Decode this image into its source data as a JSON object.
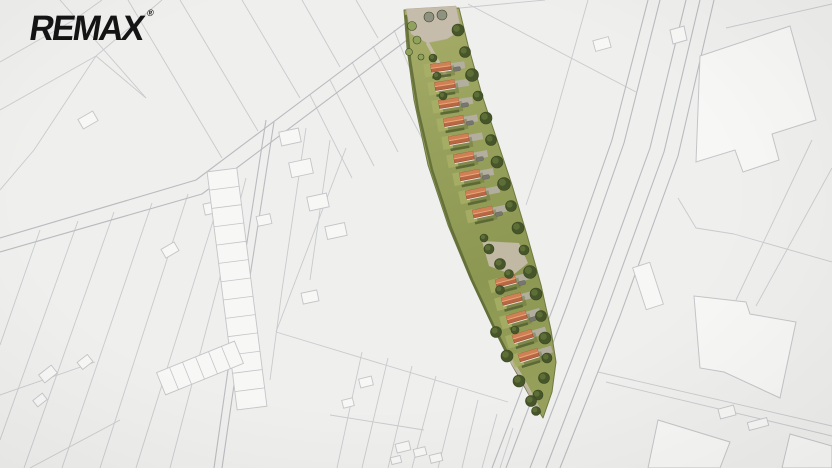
{
  "logo": {
    "text": "REMAX",
    "trademark": "®",
    "color": "#141414"
  },
  "canvas": {
    "width": 832,
    "height": 468,
    "background": "#efefed"
  },
  "map": {
    "line_color": "#c9cacd",
    "line_color_strong": "#b9bbbf",
    "building_fill": "#f7f7f5",
    "building_stroke": "#c4c5c8",
    "roads": [
      {
        "p": [
          [
            0,
            238
          ],
          [
            196,
            180
          ],
          [
            420,
            12
          ]
        ]
      },
      {
        "p": [
          [
            0,
            252
          ],
          [
            202,
            194
          ],
          [
            427,
            25
          ]
        ]
      },
      {
        "p": [
          [
            266,
            120
          ],
          [
            238,
            300
          ],
          [
            214,
            468
          ]
        ]
      },
      {
        "p": [
          [
            274,
            122
          ],
          [
            246,
            302
          ],
          [
            222,
            468
          ]
        ]
      },
      {
        "p": [
          [
            648,
            0
          ],
          [
            612,
            140
          ],
          [
            556,
            300
          ],
          [
            492,
            468
          ]
        ]
      },
      {
        "p": [
          [
            660,
            0
          ],
          [
            624,
            143
          ],
          [
            568,
            303
          ],
          [
            506,
            468
          ]
        ]
      },
      {
        "p": [
          [
            686,
            0
          ],
          [
            650,
            148
          ],
          [
            592,
            308
          ],
          [
            530,
            468
          ]
        ]
      },
      {
        "p": [
          [
            700,
            0
          ],
          [
            664,
            152
          ],
          [
            606,
            312
          ],
          [
            546,
            468
          ]
        ]
      },
      {
        "p": [
          [
            714,
            0
          ],
          [
            678,
            156
          ],
          [
            620,
            316
          ],
          [
            560,
            468
          ]
        ]
      }
    ],
    "lines": [
      {
        "p": [
          [
            0,
            110
          ],
          [
            96,
            56
          ],
          [
            162,
            0
          ]
        ]
      },
      {
        "p": [
          [
            0,
            62
          ],
          [
            74,
            20
          ],
          [
            102,
            0
          ]
        ]
      },
      {
        "p": [
          [
            96,
            56
          ],
          [
            146,
            98
          ]
        ]
      },
      {
        "p": [
          [
            96,
            56
          ],
          [
            34,
            150
          ],
          [
            0,
            190
          ]
        ]
      },
      {
        "p": [
          [
            222,
            158
          ],
          [
            128,
            0
          ]
        ]
      },
      {
        "p": [
          [
            258,
            131
          ],
          [
            180,
            0
          ]
        ]
      },
      {
        "p": [
          [
            300,
            98
          ],
          [
            242,
            0
          ]
        ]
      },
      {
        "p": [
          [
            340,
            67
          ],
          [
            302,
            0
          ]
        ]
      },
      {
        "p": [
          [
            378,
            38
          ],
          [
            356,
            0
          ]
        ]
      },
      {
        "p": [
          [
            146,
            98
          ],
          [
            60,
            0
          ]
        ]
      },
      {
        "p": [
          [
            40,
            230
          ],
          [
            0,
            345
          ]
        ]
      },
      {
        "p": [
          [
            78,
            221
          ],
          [
            0,
            440
          ]
        ]
      },
      {
        "p": [
          [
            114,
            212
          ],
          [
            24,
            468
          ]
        ]
      },
      {
        "p": [
          [
            152,
            203
          ],
          [
            62,
            468
          ]
        ]
      },
      {
        "p": [
          [
            188,
            194
          ],
          [
            100,
            468
          ]
        ]
      },
      {
        "p": [
          [
            224,
            186
          ],
          [
            136,
            468
          ]
        ]
      },
      {
        "p": [
          [
            246,
            178
          ],
          [
            170,
            468
          ]
        ]
      },
      {
        "p": [
          [
            0,
            395
          ],
          [
            95,
            362
          ]
        ]
      },
      {
        "p": [
          [
            30,
            468
          ],
          [
            120,
            420
          ]
        ]
      },
      {
        "p": [
          [
            306,
            128
          ],
          [
            282,
            290
          ],
          [
            270,
            380
          ]
        ]
      },
      {
        "p": [
          [
            330,
            140
          ],
          [
            310,
            280
          ]
        ]
      },
      {
        "p": [
          [
            346,
            148
          ],
          [
            276,
            332
          ]
        ]
      },
      {
        "p": [
          [
            276,
            332
          ],
          [
            508,
            402
          ]
        ]
      },
      {
        "p": [
          [
            310,
            95
          ],
          [
            352,
            178
          ]
        ]
      },
      {
        "p": [
          [
            330,
            80
          ],
          [
            374,
            166
          ]
        ]
      },
      {
        "p": [
          [
            352,
            62
          ],
          [
            398,
            152
          ]
        ]
      },
      {
        "p": [
          [
            373,
            46
          ],
          [
            424,
            142
          ]
        ]
      },
      {
        "p": [
          [
            394,
            30
          ],
          [
            430,
            118
          ]
        ]
      },
      {
        "p": [
          [
            362,
            352
          ],
          [
            337,
            468
          ]
        ]
      },
      {
        "p": [
          [
            388,
            358
          ],
          [
            362,
            468
          ]
        ]
      },
      {
        "p": [
          [
            412,
            366
          ],
          [
            388,
            468
          ]
        ]
      },
      {
        "p": [
          [
            436,
            376
          ],
          [
            412,
            468
          ]
        ]
      },
      {
        "p": [
          [
            458,
            388
          ],
          [
            438,
            468
          ]
        ]
      },
      {
        "p": [
          [
            478,
            400
          ],
          [
            462,
            468
          ]
        ]
      },
      {
        "p": [
          [
            497,
            414
          ],
          [
            482,
            468
          ]
        ]
      },
      {
        "p": [
          [
            513,
            428
          ],
          [
            500,
            468
          ]
        ]
      },
      {
        "p": [
          [
            330,
            415
          ],
          [
            424,
            430
          ]
        ]
      },
      {
        "p": [
          [
            460,
            8
          ],
          [
            545,
            0
          ]
        ]
      },
      {
        "p": [
          [
            468,
            4
          ],
          [
            636,
            92
          ]
        ]
      },
      {
        "p": [
          [
            588,
            0
          ],
          [
            552,
            128
          ],
          [
            526,
            205
          ]
        ]
      },
      {
        "p": [
          [
            726,
            28
          ],
          [
            832,
            4
          ]
        ]
      },
      {
        "p": [
          [
            678,
            198
          ],
          [
            696,
            228
          ],
          [
            734,
            234
          ],
          [
            832,
            262
          ]
        ]
      },
      {
        "p": [
          [
            812,
            140
          ],
          [
            736,
            300
          ]
        ]
      },
      {
        "p": [
          [
            832,
            168
          ],
          [
            756,
            306
          ]
        ]
      },
      {
        "p": [
          [
            598,
            372
          ],
          [
            832,
            426
          ]
        ]
      },
      {
        "p": [
          [
            606,
            382
          ],
          [
            832,
            436
          ]
        ]
      }
    ],
    "buildings": [
      [
        [
          700,
          56
        ],
        [
          790,
          26
        ],
        [
          816,
          120
        ],
        [
          772,
          134
        ],
        [
          779,
          160
        ],
        [
          743,
          172
        ],
        [
          735,
          150
        ],
        [
          696,
          162
        ]
      ],
      [
        [
          670,
          30
        ],
        [
          684,
          26
        ],
        [
          687,
          40
        ],
        [
          673,
          44
        ]
      ],
      [
        [
          694,
          296
        ],
        [
          746,
          302
        ],
        [
          750,
          314
        ],
        [
          796,
          322
        ],
        [
          780,
          398
        ],
        [
          724,
          372
        ],
        [
          700,
          368
        ]
      ],
      [
        [
          658,
          420
        ],
        [
          730,
          442
        ],
        [
          720,
          468
        ],
        [
          648,
          468
        ]
      ],
      [
        [
          790,
          434
        ],
        [
          832,
          446
        ],
        [
          832,
          468
        ],
        [
          782,
          468
        ]
      ]
    ],
    "rects": [
      [
        88,
        120,
        17,
        11,
        -30
      ],
      [
        290,
        137,
        20,
        14,
        -12
      ],
      [
        301,
        168,
        22,
        15,
        -12
      ],
      [
        318,
        202,
        20,
        14,
        -12
      ],
      [
        336,
        231,
        20,
        13,
        -12
      ],
      [
        212,
        208,
        16,
        11,
        -12
      ],
      [
        264,
        220,
        14,
        10,
        -12
      ],
      [
        170,
        250,
        15,
        10,
        -30
      ],
      [
        48,
        374,
        16,
        10,
        -38
      ],
      [
        85,
        362,
        13,
        9,
        -38
      ],
      [
        40,
        400,
        12,
        8,
        -38
      ],
      [
        348,
        403,
        11,
        8,
        -14
      ],
      [
        403,
        447,
        14,
        9,
        -14
      ],
      [
        420,
        452,
        12,
        8,
        -14
      ],
      [
        436,
        458,
        12,
        8,
        -14
      ],
      [
        396,
        460,
        10,
        7,
        -14
      ],
      [
        310,
        297,
        16,
        11,
        -12
      ],
      [
        366,
        382,
        13,
        9,
        -14
      ],
      [
        727,
        412,
        16,
        10,
        -15
      ],
      [
        758,
        424,
        20,
        8,
        -15
      ],
      [
        648,
        286,
        18,
        44,
        -18
      ],
      [
        602,
        44,
        16,
        11,
        -15
      ]
    ],
    "terraces": [
      {
        "cx": 237,
        "cy": 289,
        "len": 240,
        "wid": 30,
        "rot": -7.2,
        "cells": 13,
        "axis": "v"
      },
      {
        "cx": 200,
        "cy": 368,
        "len": 84,
        "wid": 24,
        "rot": -22,
        "cells": 6,
        "axis": "h"
      }
    ]
  },
  "site_plan": {
    "colors": {
      "grass_light": "#a9ae69",
      "grass_mid": "#98a25d",
      "grass_dark": "#8c9752",
      "edge": "#6f7942",
      "hedge": "#5d6a35",
      "tree_dark": "#46552a",
      "tree_hi": "#64743b",
      "tree_rim": "#39471f",
      "bush_light": "#8fa15c",
      "bush_gray": "#8f9183",
      "roof": "#b96644",
      "roof_light": "#d08055",
      "ridge": "#e8a878",
      "roof_edge": "#8f4e2e",
      "wall": "#e7e2d4",
      "shadow": "#5f6a38",
      "drive": "#b4afa2",
      "tan": "#c6bcab",
      "car": "#77766f",
      "car_edge": "#5f5e58",
      "lawn": "#a9b066"
    },
    "outline": [
      [
        404,
        10
      ],
      [
        407,
        48
      ],
      [
        414,
        100
      ],
      [
        428,
        165
      ],
      [
        448,
        225
      ],
      [
        470,
        278
      ],
      [
        492,
        325
      ],
      [
        512,
        365
      ],
      [
        528,
        393
      ],
      [
        543,
        418
      ],
      [
        552,
        392
      ],
      [
        556,
        362
      ],
      [
        551,
        330
      ],
      [
        541,
        285
      ],
      [
        527,
        235
      ],
      [
        512,
        185
      ],
      [
        497,
        140
      ],
      [
        482,
        95
      ],
      [
        468,
        45
      ],
      [
        459,
        8
      ]
    ],
    "left_edge": [
      [
        406,
        16
      ],
      [
        410,
        60
      ],
      [
        418,
        110
      ],
      [
        432,
        170
      ],
      [
        451,
        228
      ],
      [
        472,
        280
      ],
      [
        494,
        327
      ],
      [
        514,
        366
      ],
      [
        529,
        393
      ],
      [
        540,
        412
      ]
    ],
    "entrance_patch": [
      [
        406,
        9
      ],
      [
        456,
        6
      ],
      [
        461,
        30
      ],
      [
        447,
        39
      ],
      [
        427,
        43
      ],
      [
        411,
        34
      ]
    ],
    "mid_patch": [
      [
        482,
        241
      ],
      [
        519,
        243
      ],
      [
        528,
        263
      ],
      [
        513,
        275
      ],
      [
        489,
        266
      ]
    ],
    "path_strokes": [
      [
        [
          428,
          44
        ],
        [
          438,
          62
        ],
        [
          446,
          76
        ]
      ],
      [
        [
          506,
          352
        ],
        [
          522,
          378
        ],
        [
          538,
          408
        ]
      ]
    ],
    "houses": [
      [
        441,
        68,
        -8
      ],
      [
        445,
        86,
        -9
      ],
      [
        449,
        104,
        -9
      ],
      [
        454,
        122,
        -10
      ],
      [
        459,
        140,
        -10
      ],
      [
        464,
        158,
        -11
      ],
      [
        470,
        176,
        -11
      ],
      [
        476,
        194,
        -12
      ],
      [
        483,
        213,
        -12
      ],
      [
        506,
        282,
        -15
      ],
      [
        512,
        300,
        -15
      ],
      [
        517,
        318,
        -16
      ],
      [
        523,
        337,
        -17
      ],
      [
        529,
        356,
        -17
      ]
    ],
    "car_house_indices": [
      0,
      2,
      3,
      5,
      6,
      8,
      9,
      11,
      13
    ],
    "car_offset": [
      16,
      1
    ],
    "trees_right": [
      [
        458,
        30,
        6
      ],
      [
        465,
        52,
        5.5
      ],
      [
        472,
        75,
        6.5
      ],
      [
        478,
        96,
        5
      ],
      [
        486,
        118,
        6
      ],
      [
        491,
        140,
        5.5
      ],
      [
        497,
        162,
        6
      ],
      [
        504,
        184,
        6.5
      ],
      [
        511,
        206,
        5.5
      ],
      [
        518,
        228,
        6
      ],
      [
        524,
        250,
        5
      ],
      [
        530,
        272,
        6.5
      ],
      [
        536,
        294,
        6
      ],
      [
        541,
        316,
        5.5
      ],
      [
        545,
        338,
        6
      ],
      [
        547,
        358,
        5
      ],
      [
        544,
        378,
        5.5
      ],
      [
        538,
        395,
        5
      ]
    ],
    "trees_left": [
      [
        496,
        332,
        5.5
      ],
      [
        507,
        356,
        6
      ],
      [
        519,
        381,
        6
      ],
      [
        531,
        401,
        5.5
      ],
      [
        536,
        411,
        4.5
      ]
    ],
    "trees_mid": [
      [
        489,
        249,
        5
      ],
      [
        500,
        264,
        5.5
      ],
      [
        509,
        274,
        4.5
      ],
      [
        484,
        238,
        4
      ]
    ],
    "trees_inner": [
      [
        437,
        76,
        4
      ],
      [
        443,
        96,
        4
      ],
      [
        433,
        58,
        4
      ],
      [
        500,
        290,
        4.5
      ],
      [
        515,
        330,
        4
      ]
    ],
    "bushes_light": [
      [
        412,
        26,
        4.5
      ],
      [
        417,
        40,
        4
      ],
      [
        409,
        52,
        3.5
      ],
      [
        421,
        57,
        3
      ]
    ],
    "bushes_gray": [
      [
        429,
        17,
        5
      ],
      [
        442,
        15,
        5
      ]
    ]
  }
}
